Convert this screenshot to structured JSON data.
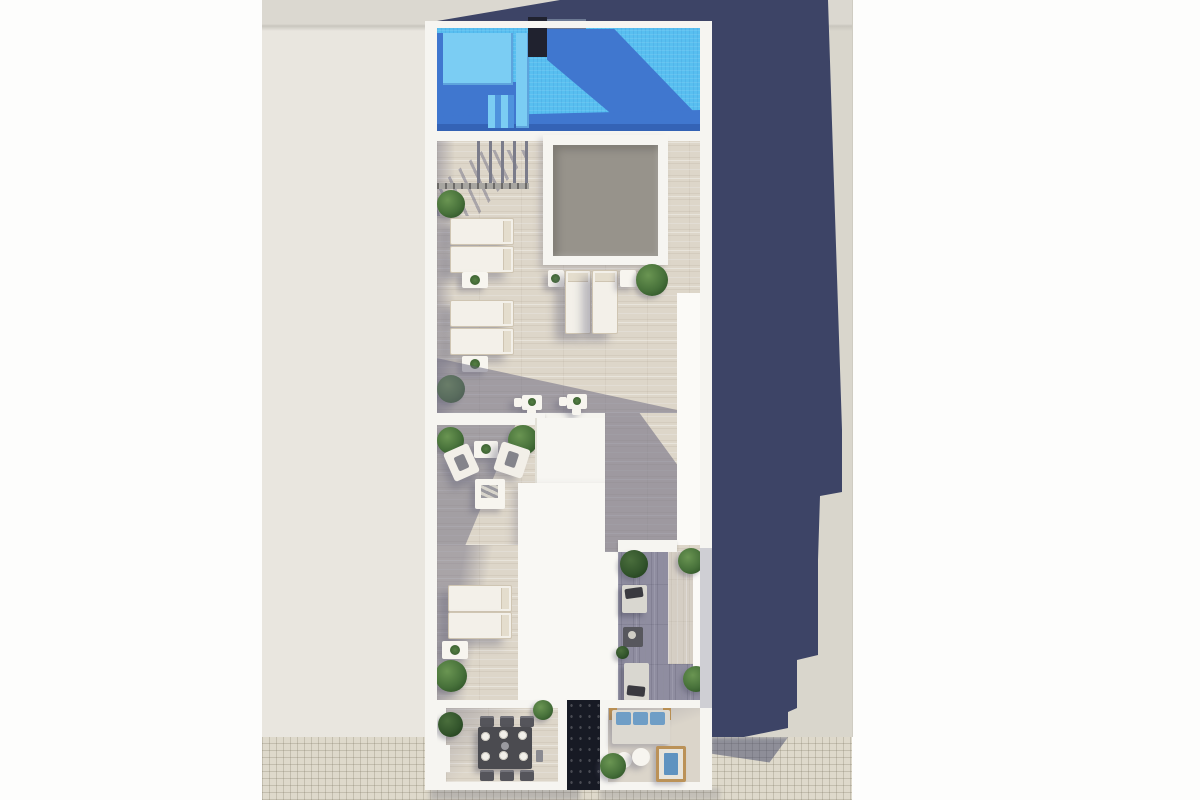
{
  "scene": {
    "type": "3D rendered top-down floor plan of a rooftop pool terrace",
    "labels": {
      "canvas": "aerial view of rooftop terrace",
      "pool": "swimming pool with entry steps",
      "pool_steps": "pool steps / tanning shelf",
      "pool_equipment": "dark pool-side unit",
      "sun_deck": "sun deck with wooden flooring",
      "skylight": "central skylight (grey glazing)",
      "railing": "glass railing with posts beside pool",
      "sun_lounger": "white sun lounger",
      "side_table": "white side table with plant",
      "bistro_set": "bistro table with chairs",
      "lounge_area": "lounge with two armchairs and coffee table",
      "roof_volume": "white rooftop access volume",
      "daybed": "grey daybed with cushion",
      "dining_area": "dining terrace with table for six",
      "stairwell": "dark stair void",
      "sofa_blue": "sofa with blue cushions",
      "round_table": "round side table",
      "wood_lounger": "wooden lounger with blue cushion",
      "plant": "green shrub in planter",
      "building_shadow": "shadow cast by building on ground",
      "ground": "surrounding ground / neighbouring roofs",
      "tile_ground": "tiled pavement strip"
    },
    "inventory": {
      "sun_loungers_left_column": 4,
      "sun_loungers_center": 2,
      "sun_loungers_lower_left": 2,
      "armchairs": 2,
      "bistro_sets": 2,
      "dining_chairs": 6,
      "dining_plates": 6,
      "blue_sofa_cushions": 3,
      "round_side_tables": 2,
      "daybeds": 2,
      "wood_loungers": 1,
      "plants": 12,
      "skylights": 1,
      "stairwells": 1
    },
    "palette": {
      "background_white": "#fdfdfc",
      "ground_beige": "#e9e6df",
      "ground_right_beige": "#d9d6cc",
      "tile_ground": "#ded9cb",
      "cast_shadow_navy": "#3d4466",
      "building_white": "#f5f4ef",
      "pool_water": "#58bff0",
      "pool_water_shadow": "#4077cf",
      "pool_deep_line": "#3463b6",
      "pool_step": "#7bcdf3",
      "pool_dark_unit": "#20222f",
      "plank_floor_lit": "#ddd6c9",
      "plank_floor_shaded": "#8f8da0",
      "skylight_grey": "#97938b",
      "plant_green": "#47713a",
      "dining_table_grey": "#4b4b50",
      "cushion_blue": "#6f9ec6",
      "wood_tan": "#bb9258",
      "stairwell_dark": "#171a24"
    }
  }
}
